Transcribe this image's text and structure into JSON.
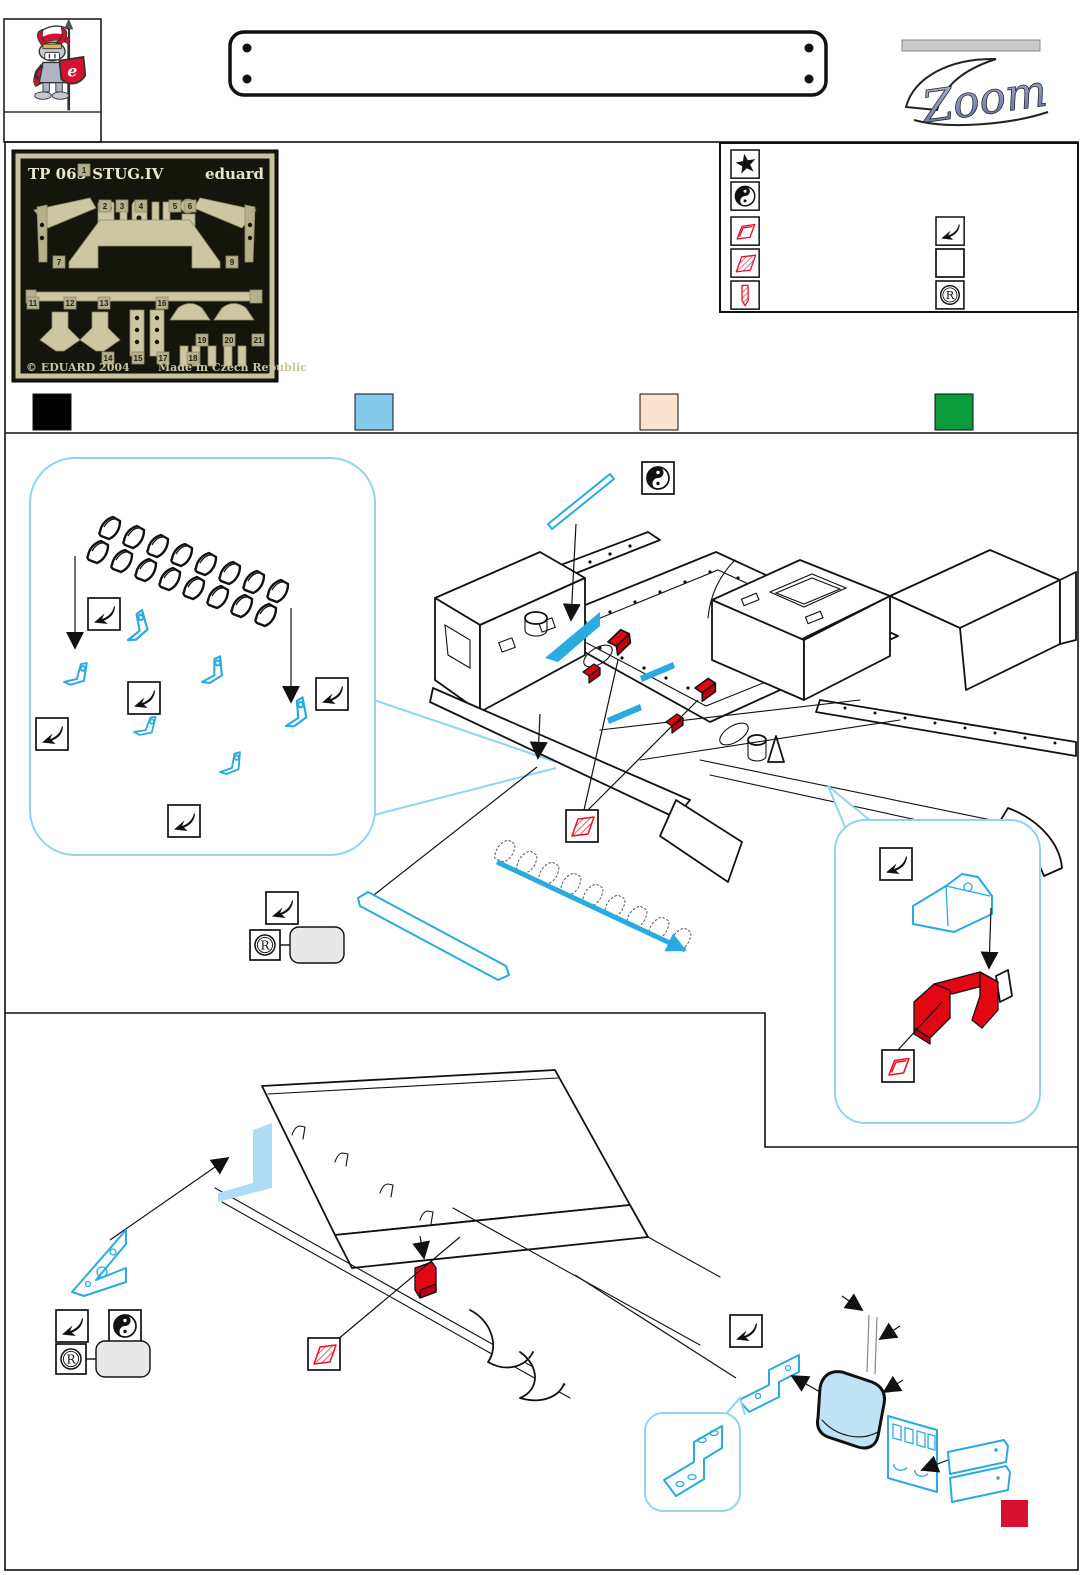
{
  "header": {
    "zoom_logo_text": "Zoom",
    "knight_shield_letter": "e"
  },
  "fret_photo": {
    "title": "TP 065 STUG.IV",
    "brand": "eduard",
    "copyright": "© EDUARD 2004",
    "made_in": "Made in Czech Republic",
    "part_numbers": [
      "1",
      "2",
      "3",
      "4",
      "5",
      "6",
      "7",
      "9",
      "11",
      "12",
      "13",
      "14",
      "15",
      "16",
      "17",
      "18",
      "19",
      "20",
      "21"
    ]
  },
  "symbol_legend": {
    "left_icons": [
      "star-icon",
      "yin-yang-icon",
      "open-parallelogram-icon",
      "hatched-parallelogram-icon",
      "drill-icon"
    ],
    "right_icons": [
      "bend-arrow-icon",
      "empty-box-icon",
      "registered-icon"
    ]
  },
  "color_key": {
    "swatches": [
      {
        "name": "black",
        "hex": "#000000"
      },
      {
        "name": "pe-blue",
        "hex": "#85C9ED"
      },
      {
        "name": "peach",
        "hex": "#FBE3D0"
      },
      {
        "name": "green",
        "hex": "#089C3C"
      }
    ]
  },
  "artwork_colors": {
    "pe_line_blue": "#29ABE2",
    "pe_fill_blue": "#BFE2F5",
    "paint_red": "#E30613",
    "accent_red": "#D6102F",
    "bubble_outline": "#8FD4F2",
    "symbol_red": "#E8112D",
    "fret_brass": "#CCC7A2",
    "fret_background": "#14160C"
  }
}
